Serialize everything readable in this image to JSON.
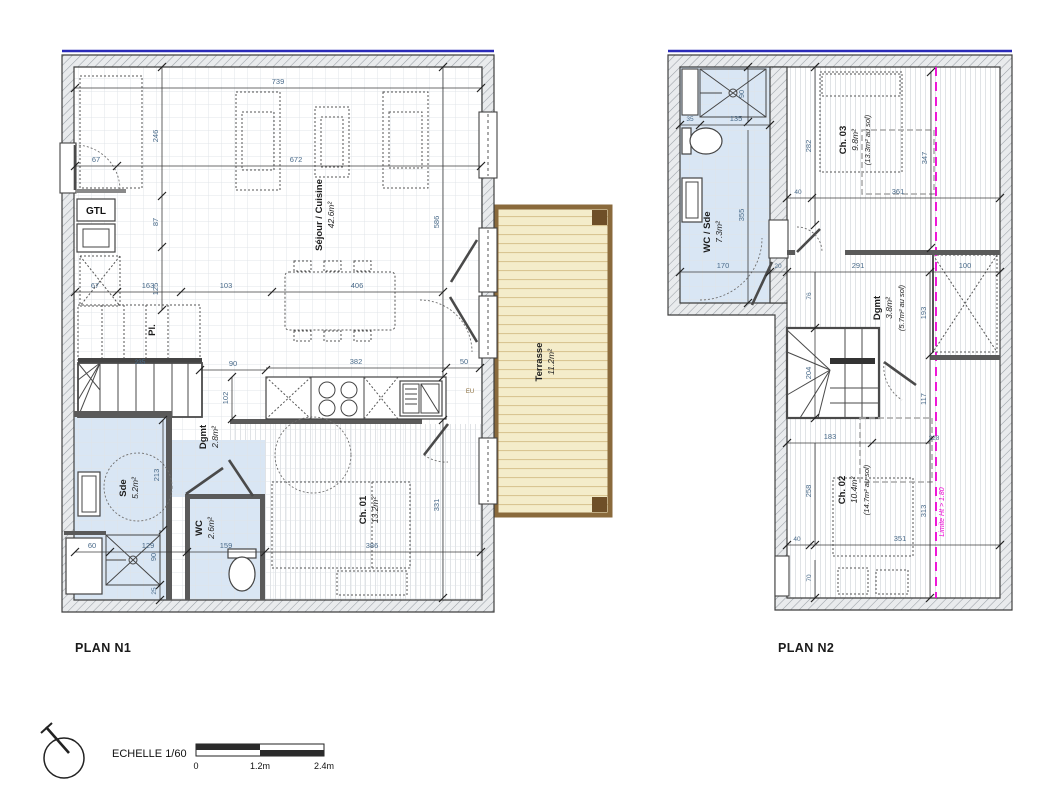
{
  "document": {
    "type": "architectural-floor-plan",
    "plans": [
      "PLAN N1",
      "PLAN N2"
    ]
  },
  "plan1": {
    "title": "PLAN N1",
    "rooms": [
      {
        "name": "Séjour / Cuisine",
        "area": "42.6m²"
      },
      {
        "name": "Terrasse",
        "area": "11.2m²"
      },
      {
        "name": "Ch. 01",
        "area": "13.2m²"
      },
      {
        "name": "Sde",
        "area": "5.2m²"
      },
      {
        "name": "WC",
        "area": "2.6m²"
      },
      {
        "name": "Dgmt",
        "area": "2.8m²"
      }
    ],
    "labels": {
      "gtl": "GTL",
      "pl": "Pl.",
      "eu": "EU"
    },
    "dims": [
      "739",
      "246",
      "67",
      "672",
      "87",
      "586",
      "125",
      "67",
      "163",
      "103",
      "406",
      "90",
      "382",
      "50",
      "102",
      "235",
      "213",
      "331",
      "60",
      "129",
      "159",
      "386",
      "90",
      "25"
    ]
  },
  "plan2": {
    "title": "PLAN N2",
    "rooms": [
      {
        "name": "WC / Sde",
        "area": "7.3m²"
      },
      {
        "name": "Ch. 03",
        "area": "9.8m²",
        "area_sol": "(13.3m² au sol)"
      },
      {
        "name": "Dgmt",
        "area": "3.8m²",
        "area_sol": "(5.7m² au sol)"
      },
      {
        "name": "Ch. 02",
        "area": "10.4m²",
        "area_sol": "(14.7m² au sol)"
      }
    ],
    "limit_label": "Limite Ht > 1.80",
    "dims": [
      "90",
      "35",
      "135",
      "282",
      "347",
      "40",
      "361",
      "355",
      "170",
      "20",
      "291",
      "100",
      "76",
      "193",
      "117",
      "204",
      "183",
      "228",
      "258",
      "313",
      "40",
      "351",
      "70"
    ]
  },
  "footer": {
    "scale_label": "ECHELLE 1/60",
    "scale_ticks": [
      "0",
      "1.2m",
      "2.4m"
    ]
  },
  "colors": {
    "wall_hatch_bg": "#e9ebed",
    "wall_hatch_line": "#9aa0a6",
    "wet_room_blue": "#d9e6f4",
    "terrace_fill": "#f4ecca",
    "terrace_border": "#8a6a3c",
    "terrace_post": "#6e4f28",
    "dimension_text": "#4a6b8a",
    "limit_magenta": "#ee00d4",
    "top_edge_blue": "#2a2ab8"
  }
}
